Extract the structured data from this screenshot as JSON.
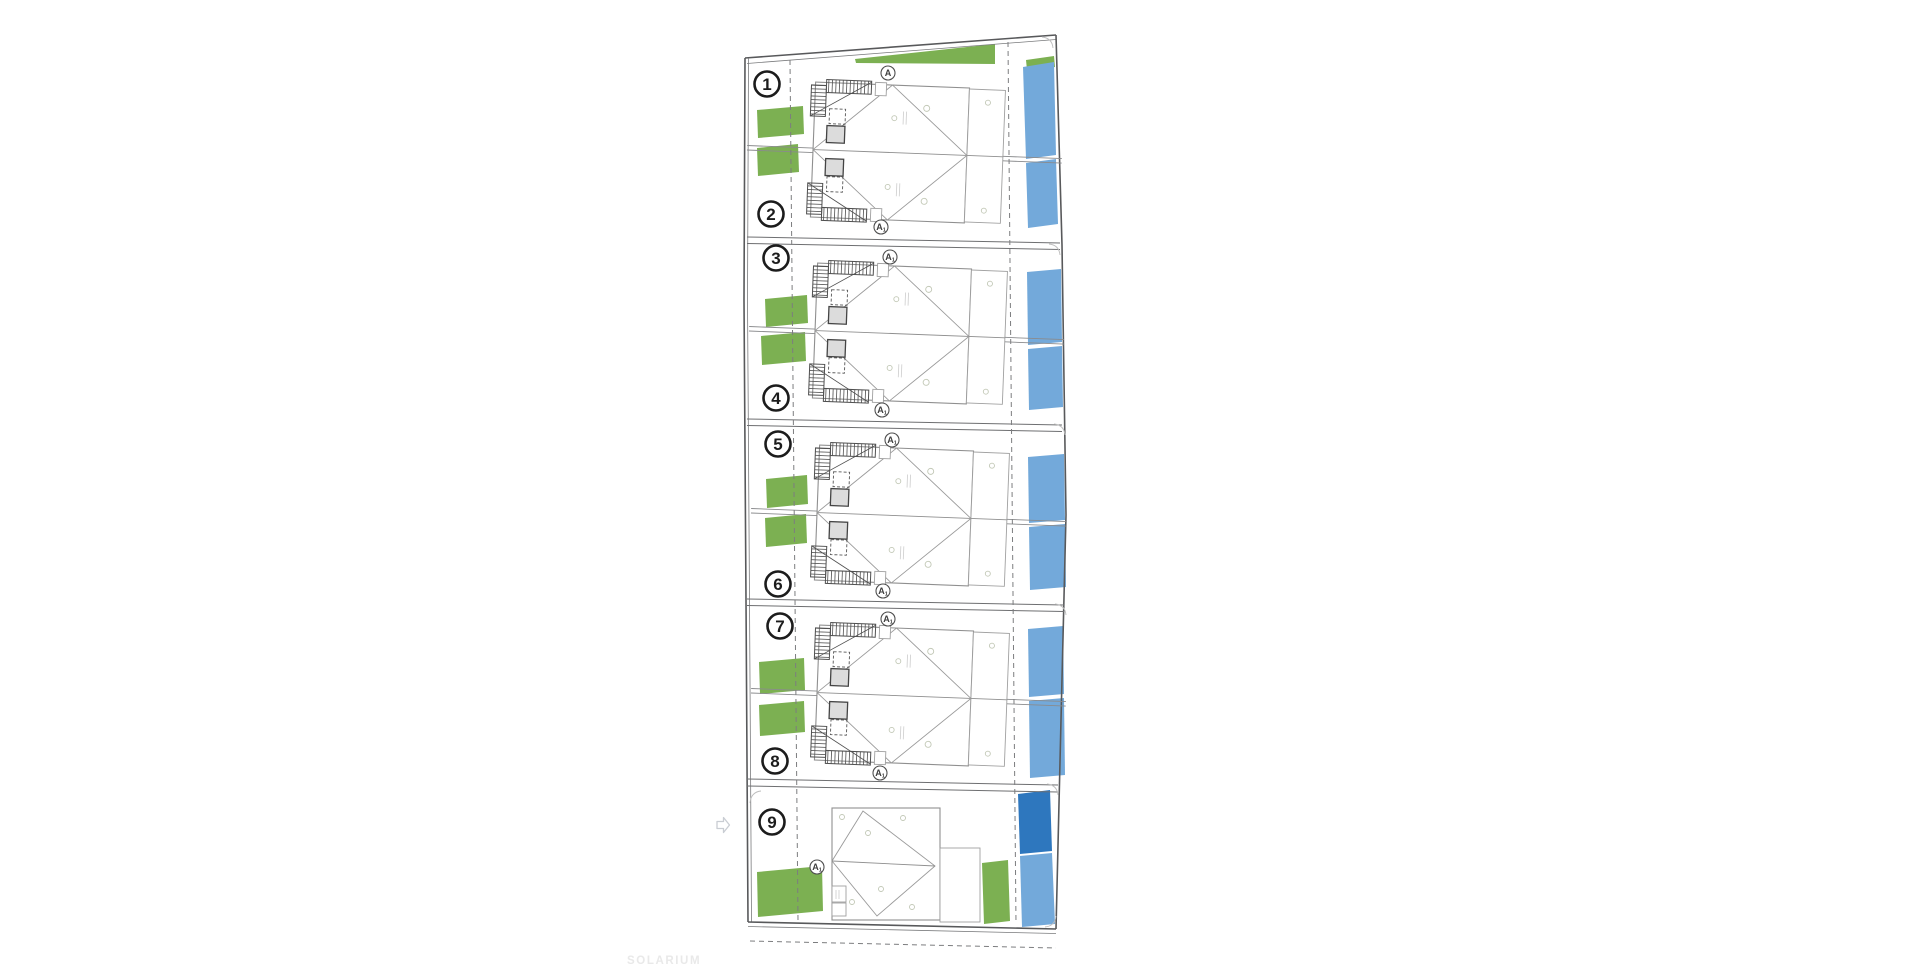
{
  "watermark": {
    "text": "SOLARIUM"
  },
  "colors": {
    "garden_green": "#7cb052",
    "pool_light": "#73a9da",
    "pool_dark": "#2e77be",
    "ink": "#1c1c1c",
    "watermark_gray": "#e9e9e9"
  },
  "plan": {
    "units": [
      {
        "label": "1",
        "x": 767,
        "y": 84
      },
      {
        "label": "2",
        "x": 771,
        "y": 214
      },
      {
        "label": "3",
        "x": 776,
        "y": 258
      },
      {
        "label": "4",
        "x": 776,
        "y": 398
      },
      {
        "label": "5",
        "x": 778,
        "y": 444
      },
      {
        "label": "6",
        "x": 778,
        "y": 584
      },
      {
        "label": "7",
        "x": 780,
        "y": 626
      },
      {
        "label": "8",
        "x": 775,
        "y": 761
      },
      {
        "label": "9",
        "x": 772,
        "y": 822
      }
    ],
    "section_markers": [
      {
        "label": "A",
        "sub": "",
        "x": 888,
        "y": 73
      },
      {
        "label": "A",
        "sub": "1",
        "x": 881,
        "y": 227
      },
      {
        "label": "A",
        "sub": "1",
        "x": 890,
        "y": 257
      },
      {
        "label": "A",
        "sub": "1",
        "x": 882,
        "y": 410
      },
      {
        "label": "A",
        "sub": "1",
        "x": 892,
        "y": 440
      },
      {
        "label": "A",
        "sub": "1",
        "x": 883,
        "y": 591
      },
      {
        "label": "A",
        "sub": "1",
        "x": 888,
        "y": 619
      },
      {
        "label": "A",
        "sub": "1",
        "x": 880,
        "y": 773
      },
      {
        "label": "A",
        "sub": "1",
        "x": 817,
        "y": 867
      }
    ]
  }
}
